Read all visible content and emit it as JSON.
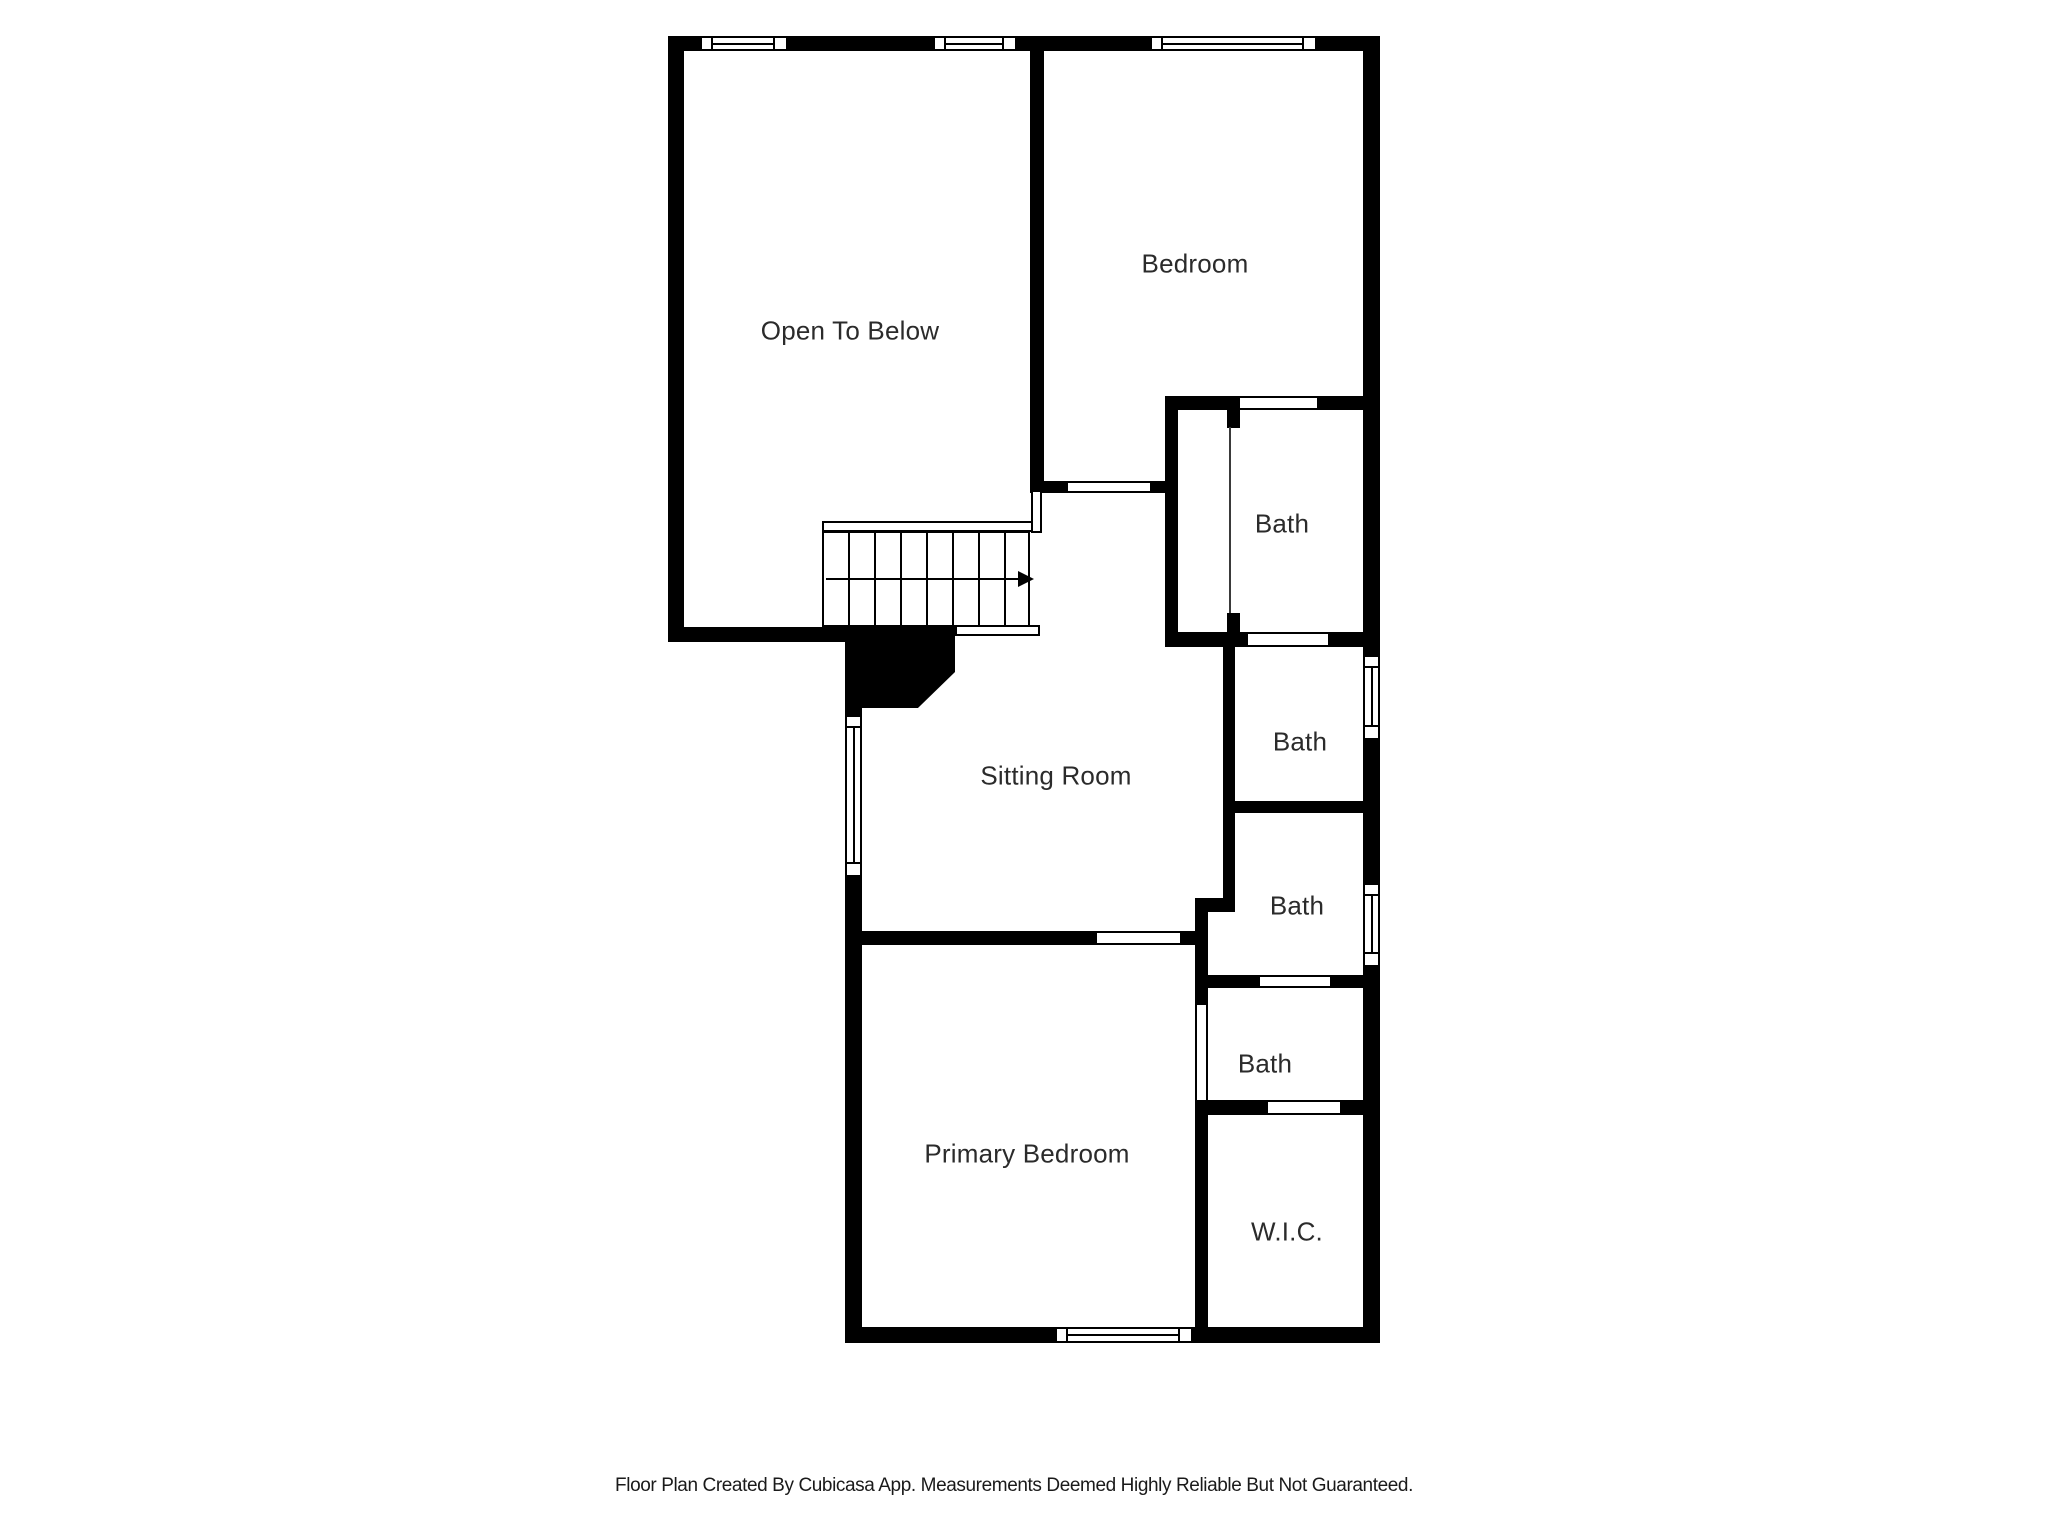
{
  "colors": {
    "background": "#ffffff",
    "wall": "#000000",
    "label_text": "#2b2b2b"
  },
  "rooms": [
    {
      "label": "Open To Below"
    },
    {
      "label": "Bedroom"
    },
    {
      "label": "Bath"
    },
    {
      "label": "Bath"
    },
    {
      "label": "Bath"
    },
    {
      "label": "Bath"
    },
    {
      "label": "Sitting Room"
    },
    {
      "label": "Primary Bedroom"
    },
    {
      "label": "W.I.C."
    }
  ],
  "stairs": {
    "direction_arrow": "right"
  },
  "footer": {
    "text": "Floor Plan Created By Cubicasa App. Measurements Deemed Highly Reliable But Not Guaranteed."
  }
}
